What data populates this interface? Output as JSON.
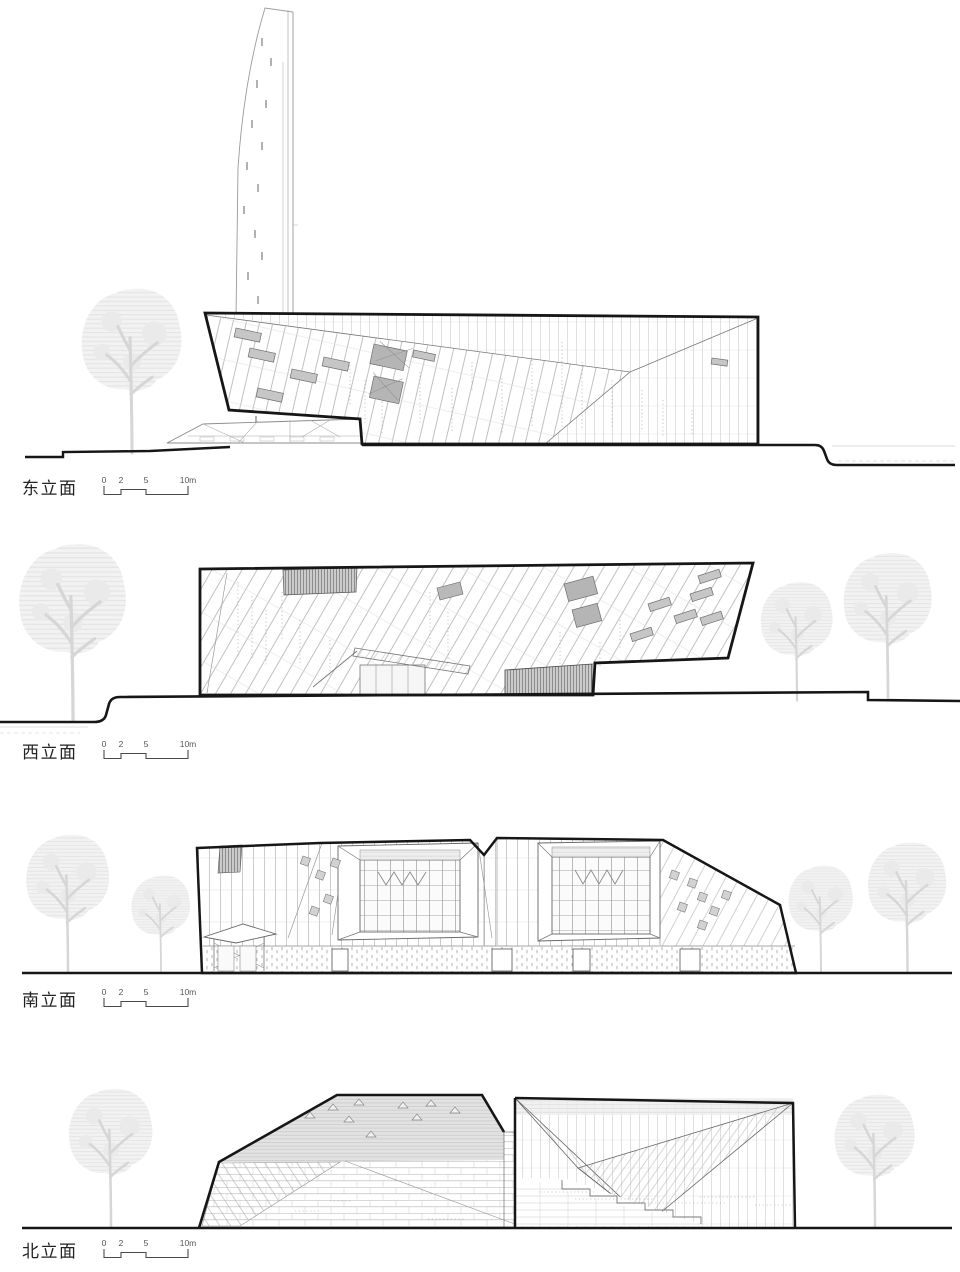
{
  "figures": [
    {
      "id": "east-elevation",
      "label": "东立面"
    },
    {
      "id": "west-elevation",
      "label": "西立面"
    },
    {
      "id": "south-elevation",
      "label": "南立面"
    },
    {
      "id": "north-elevation",
      "label": "北立面"
    }
  ],
  "scale_bar": {
    "ticks": [
      "0",
      "2",
      "5",
      "10m"
    ]
  },
  "colors": {
    "ink": "#161616",
    "line_light": "#9e9e9e",
    "tree_silhouette": "#ececec",
    "window_fill": "#c6c6c6",
    "paper": "#ffffff"
  }
}
